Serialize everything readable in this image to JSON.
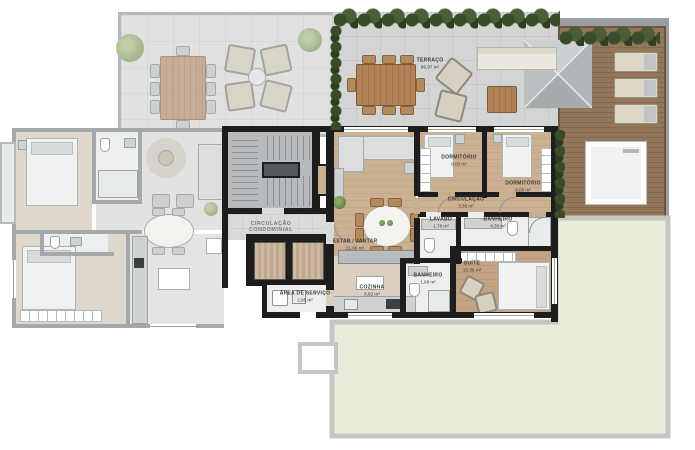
{
  "plan_title": "apartment-floor-plan",
  "rooms": {
    "terraco": {
      "name": "TERRAÇO",
      "area": "86,87 m²"
    },
    "dormitorio_1": {
      "name": "DORMITÓRIO",
      "area": "8,00 m²"
    },
    "dormitorio_2": {
      "name": "DORMITÓRIO",
      "area": "8,06 m²"
    },
    "circulacao": {
      "name": "CIRCULAÇÃO",
      "area": "3,35 m²"
    },
    "lavabo": {
      "name": "LAVABO",
      "area": "1,78 m²"
    },
    "banheiro_1": {
      "name": "BANHEIRO",
      "area": "4,30 m²"
    },
    "banheiro_2": {
      "name": "BANHEIRO",
      "area": "1,98 m²"
    },
    "suite": {
      "name": "SUÍTE",
      "area": "15,36 m²"
    },
    "estar_jantar": {
      "name": "ESTAR / JANTAR",
      "area": "21,66 m²"
    },
    "cozinha": {
      "name": "COZINHA",
      "area": "8,82 m²"
    },
    "area_servico": {
      "name": "ÁREA DE SERVIÇO",
      "area": "2,95 m²"
    },
    "circulacao_condominial": {
      "line1": "CIRCULAÇÃO",
      "line2": "CONDOMINIAL"
    }
  },
  "colors": {
    "wall_active": "#1d1d1d",
    "wall_faded": "#a4a8aa",
    "wood": "#cbb092",
    "wood_dark": "#c3a78a",
    "tile": "#edefee",
    "terrace": "#d2d5d3",
    "terrace_faded": "#e0e2e1",
    "deck": "#8d7154",
    "hedge": "#42532f",
    "lawn": "#e7edda",
    "lawn_border": "#c3c6c3",
    "roof": "#c0c4c6",
    "label": "#3e382e"
  }
}
